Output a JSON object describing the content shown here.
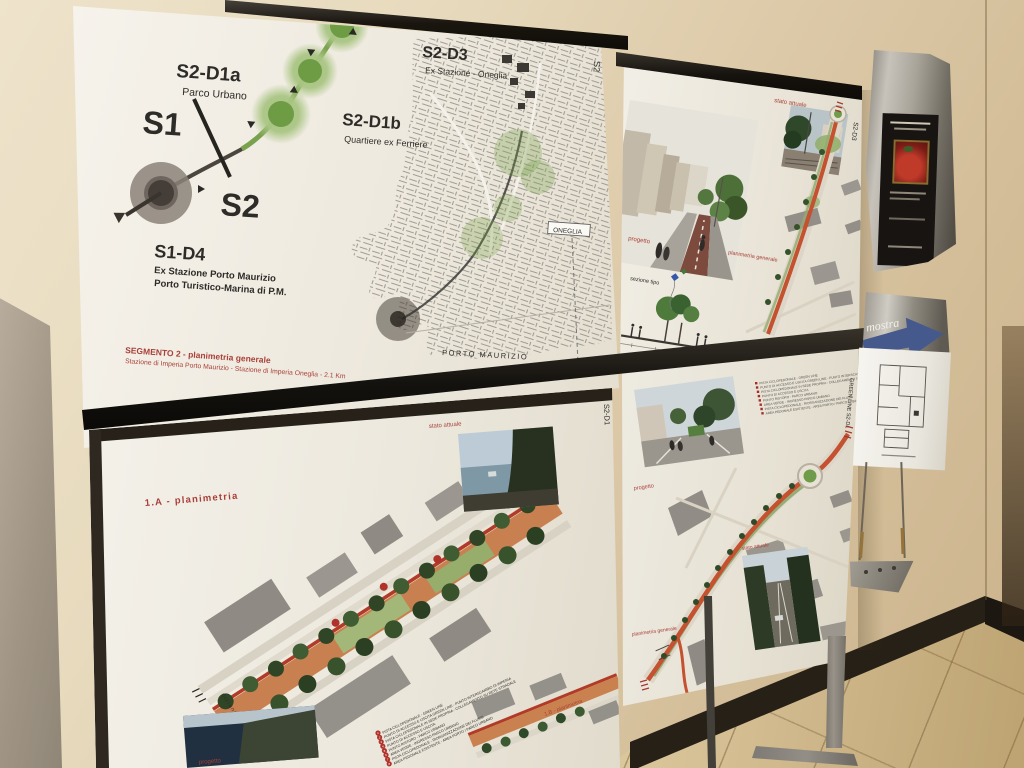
{
  "posters": {
    "overview": {
      "edge_label": "S2",
      "line_start_label": "S1",
      "line_end_label": "S2",
      "stops": [
        {
          "code": "S2-D3",
          "name": "Ex Stazione - Oneglia"
        },
        {
          "code": "S2-D1a",
          "name": "Parco Urbano"
        },
        {
          "code": "S2-D1b",
          "name": "Quartiere ex Ferriere"
        }
      ],
      "terminus": {
        "code": "S1-D4",
        "line1": "Ex Stazione Porto Maurizio",
        "line2": "Porto Turistico-Marina di P.M."
      },
      "caption_title": "SEGMENTO 2 - planimetria generale",
      "caption_subtitle": "Stazione di Imperia Porto Maurizio - Stazione di Imperia Oneglia - 2.1 Km",
      "map": {
        "label_oneglia": "ONEGLIA",
        "label_porto_maurizio": "PORTO MAURIZIO"
      }
    },
    "detail_top_right": {
      "edge_label": "S2-D3",
      "photo_label": "stato attuale",
      "render_label": "progetto",
      "section_label": "sezione tipo",
      "plan_label": "planimetria generale"
    },
    "detail_bottom_left": {
      "title": "1.A - planimetria",
      "secondary_title": "1.B - planimetria",
      "edge_label": "S2-D1",
      "photo_label": "stato attuale",
      "render_label": "progetto",
      "legend": [
        {
          "n": "1",
          "text": "PISTA CICLOPEDONALE - GREEN LINE"
        },
        {
          "n": "2",
          "text": "PUNTO DI ACCESSO E USCITA GREEN LINE - PUNTO INTERSCAMBIO DI IMPERIA"
        },
        {
          "n": "3",
          "text": "PISTA CICLOPEDONALE IN SEDE PROPRIA - COLLEGAMENTO SU RETE STRADALE"
        },
        {
          "n": "4",
          "text": "PUNTO DI ACCESSO E USCITA"
        },
        {
          "n": "5",
          "text": "PUNTO RISTORO - PARCO URBANO"
        },
        {
          "n": "6",
          "text": "AREA VERDE - INGRESSO PARCO URBANO"
        },
        {
          "n": "7",
          "text": "PISTA CICLOPEDONALE - RIORGANIZZAZIONE DEI FLUSSI"
        },
        {
          "n": "8",
          "text": "AREA PEDONALE ESISTENTE - AREA PORTO / PARCO URBANO"
        }
      ]
    },
    "detail_bottom_right": {
      "edge_label": "GREEN LINE  S2-D1",
      "photo_label": "stato attuale",
      "render_label": "progetto",
      "plan_label": "planimetria generale"
    }
  },
  "wall_items": {
    "arrow_sign_text": "mostra"
  },
  "colors": {
    "accent_green": "#6d9c44",
    "accent_red": "#a84038",
    "route_orange": "#c4512f"
  }
}
